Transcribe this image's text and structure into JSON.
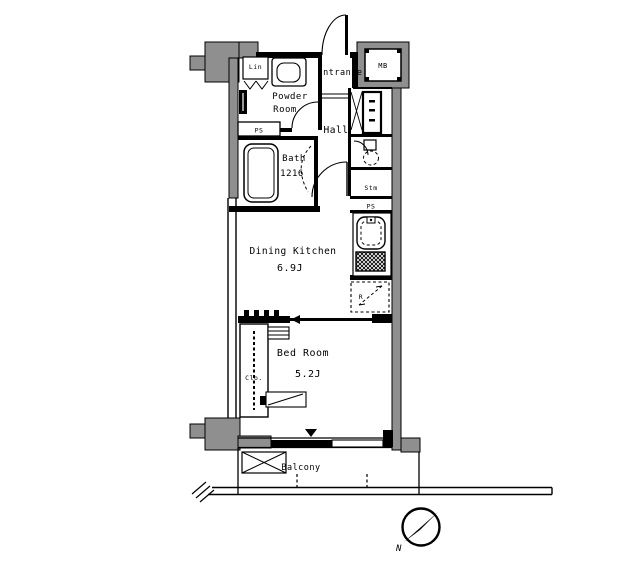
{
  "title": "Japanese apartment floor plan 1K",
  "colors": {
    "wall_fill": "#8f8f8f",
    "line": "#000000",
    "background": "#ffffff"
  },
  "labels": {
    "lin": "Lin",
    "powder_line1": "Powder",
    "powder_line2": "Room",
    "entrance": "Entrance",
    "mb": "MB",
    "hall": "Hall",
    "bath_name": "Bath",
    "bath_size": "1216",
    "ps_left": "PS",
    "ps_right": "PS",
    "stm": "Stm",
    "dk_name": "Dining Kitchen",
    "dk_size": "6.9J",
    "fridge": "R",
    "bedroom_name": "Bed Room",
    "bedroom_size": "5.2J",
    "closet": "Clo.",
    "balcony": "Balcony",
    "compass_north": "N"
  }
}
